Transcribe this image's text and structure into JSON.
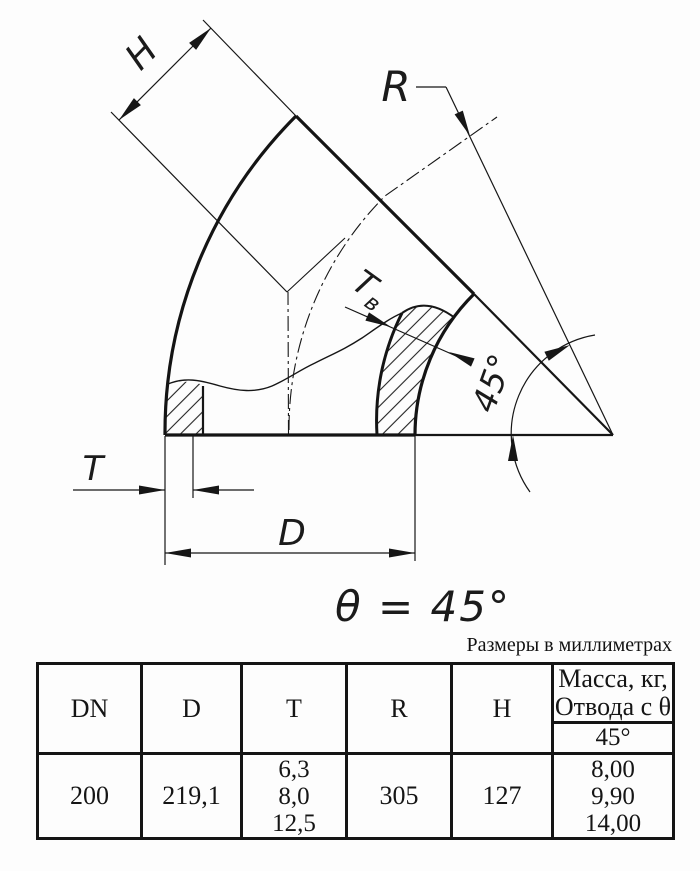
{
  "drawing": {
    "h_label": "H",
    "r_label": "R",
    "tw_label_main": "T",
    "tw_label_sub": "в",
    "angle_label": "45°",
    "t_label": "T",
    "d_label": "D",
    "theta_note": "θ = 45°",
    "units_note": "Размеры в миллиметрах"
  },
  "table": {
    "headers": {
      "dn": "DN",
      "d": "D",
      "t": "T",
      "r": "R",
      "h": "H",
      "mass_line1": "Масса, кг,",
      "mass_line2": "Отвода с θ",
      "mass_angle": "45°"
    },
    "row": {
      "dn": "200",
      "d": "219,1",
      "t": [
        "6,3",
        "8,0",
        "12,5"
      ],
      "r": "305",
      "h": "127",
      "mass": [
        "8,00",
        "9,90",
        "14,00"
      ]
    }
  }
}
